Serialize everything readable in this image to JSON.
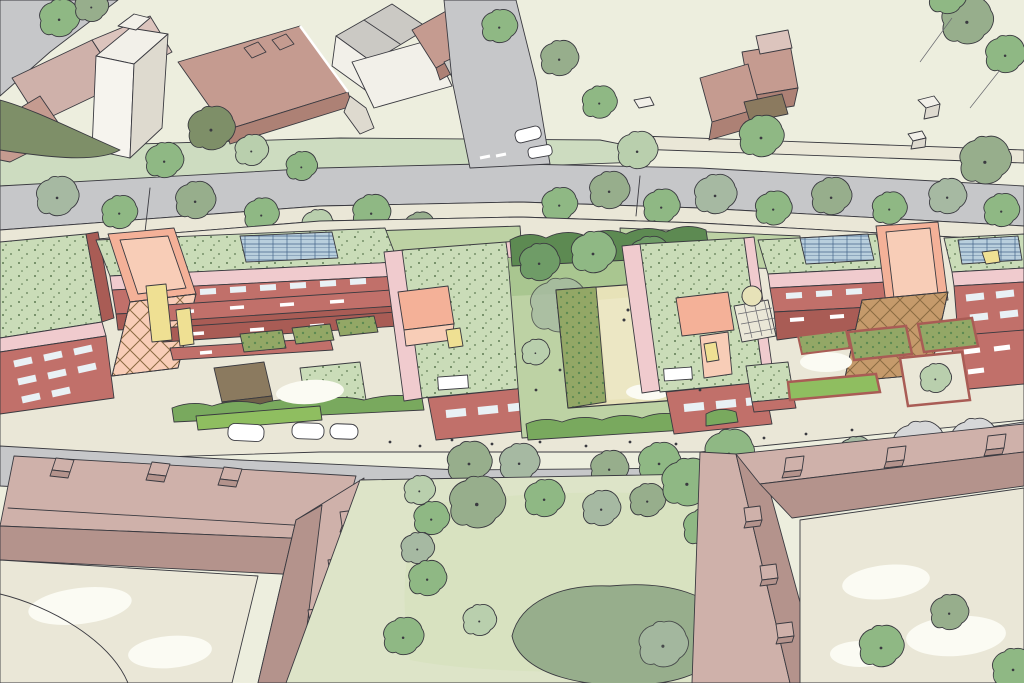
{
  "scene": {
    "title": "Hand-drawn aerial illustration of a residential masterplan: three red-brick apartment clusters with green sedum roofs, solar panels and salmon stair towers set between two tree-lined streets, a central courtyard playground, open parkland and large existing mauve-roofed perimeter buildings",
    "style": "architect's sketch / watercolour aerial perspective",
    "areas": {
      "north_west": [
        "existing city block",
        "white tower",
        "flat-roof brick building",
        "pink terraced roofs",
        "white church and school buildings",
        "corner road"
      ],
      "north_east": [
        "open green field",
        "detached brick house with garden shed",
        "small utility cubes",
        "footpath",
        "corner trees"
      ],
      "upper_street": [
        "main road",
        "side road junction",
        "white car",
        "street trees",
        "grass verges",
        "give-way markings"
      ],
      "development": [
        "left apartment cluster",
        "centre-left block",
        "communal courtyard with playground",
        "centre-right block",
        "right apartment cluster",
        "green sedum roofs",
        "rooftop solar arrays",
        "salmon stair towers with lattice screens",
        "yellow accent walls",
        "garden planters",
        "hedges",
        "brown cycle store",
        "trellis pergola",
        "footpaths with people"
      ],
      "lower_street": [
        "residential road",
        "three parked cars",
        "street trees",
        "pavement"
      ],
      "south": [
        "large existing building with courtyard (west)",
        "central green with lawns and mature trees",
        "large existing building with courtyard (east)",
        "chimneys",
        "white garden paths"
      ]
    }
  },
  "palette": {
    "paper": "#ebecdc",
    "field": "#edeede",
    "roadGray": "#c6c7c9",
    "roadLight": "#d6d7d8",
    "pathCream": "#eae7d7",
    "pathWhite": "#fbfbf3",
    "vergeGreen": "#cddcc0",
    "lawn": "#bdd2a4",
    "lawnPale": "#dde4c8",
    "lawnDeep": "#a9c690",
    "treeGreen": "#8fb884",
    "treeDark": "#6f9c67",
    "treePale": "#b9cfad",
    "treeGray": "#a6b9a2",
    "treeSage": "#97ae8c",
    "treeOlive": "#7e8f68",
    "hedge": "#79a95e",
    "hedgeBright": "#8fbe60",
    "hedgeDark": "#5d8a52",
    "ink": "#3a3a40",
    "inkSoft": "#6a6a70",
    "brick": "#c1706a",
    "brickDark": "#a95c55",
    "brickDeep": "#8f4b46",
    "pink": "#f0cbce",
    "pinkPale": "#f7dede",
    "salmon": "#f4b198",
    "salmonPale": "#f8cdb7",
    "bronze": "#c59a6b",
    "bronzeLine": "#8a6a42",
    "yellow": "#efe093",
    "roofGreen": "#cadcb8",
    "roofSpeckDot": "#5d7a52",
    "solar": "#b9cfdd",
    "solarLine": "#46658a",
    "mauve": "#cfb1aa",
    "mauveDark": "#b4938c",
    "mauveWall": "#dcc4bd",
    "offwhite": "#f2f0e9",
    "offshade": "#dedacf",
    "grayRoof": "#cbc9c4",
    "oldbrick": "#c59b90",
    "oldbrickDark": "#ad8175",
    "brown": "#8b7a5f",
    "brownDark": "#6f6049",
    "playSand": "#e7e2b8",
    "playSandLight": "#ece7c4",
    "playOlive": "#93a766",
    "benchOlive": "#6f7c40",
    "glass": "#e9f1f5",
    "carWhite": "#ffffff"
  }
}
